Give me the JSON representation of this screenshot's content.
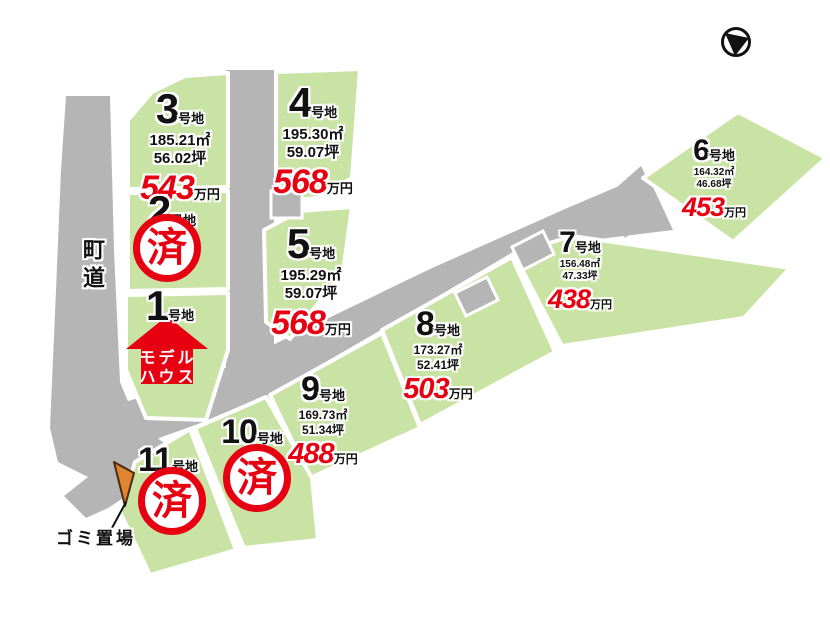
{
  "title": "宅地分譲区画図",
  "colors": {
    "lot_green": "#c9e3a5",
    "road_gray": "#b5b5b5",
    "price_red": "#e60012",
    "sold_red": "#e60012",
    "trash_orange": "#e0852f"
  },
  "labels": {
    "town_road": "町道",
    "trash_site": "ゴミ置場",
    "model_house_line1": "モデル",
    "model_house_line2": "ハウス",
    "sold": "済"
  },
  "lots": [
    {
      "number": "1",
      "suffix": "号地",
      "status": "model_house"
    },
    {
      "number": "2",
      "suffix": "号地",
      "status": "sold"
    },
    {
      "number": "3",
      "suffix": "号地",
      "area_m2": "185.21㎡",
      "area_tsubo": "56.02坪",
      "price": "543",
      "price_unit": "万円",
      "status": "for_sale"
    },
    {
      "number": "4",
      "suffix": "号地",
      "area_m2": "195.30㎡",
      "area_tsubo": "59.07坪",
      "price": "568",
      "price_unit": "万円",
      "status": "for_sale"
    },
    {
      "number": "5",
      "suffix": "号地",
      "area_m2": "195.29㎡",
      "area_tsubo": "59.07坪",
      "price": "568",
      "price_unit": "万円",
      "status": "for_sale"
    },
    {
      "number": "6",
      "suffix": "号地",
      "area_m2": "164.32㎡",
      "area_tsubo": "46.68坪",
      "price": "453",
      "price_unit": "万円",
      "status": "for_sale"
    },
    {
      "number": "7",
      "suffix": "号地",
      "area_m2": "156.48㎡",
      "area_tsubo": "47.33坪",
      "price": "438",
      "price_unit": "万円",
      "status": "for_sale"
    },
    {
      "number": "8",
      "suffix": "号地",
      "area_m2": "173.27㎡",
      "area_tsubo": "52.41坪",
      "price": "503",
      "price_unit": "万円",
      "status": "for_sale"
    },
    {
      "number": "9",
      "suffix": "号地",
      "area_m2": "169.73㎡",
      "area_tsubo": "51.34坪",
      "price": "488",
      "price_unit": "万円",
      "status": "for_sale"
    },
    {
      "number": "10",
      "suffix": "号地",
      "status": "sold"
    },
    {
      "number": "11",
      "suffix": "号地",
      "status": "sold"
    }
  ],
  "compass": {
    "icon": "north-arrow"
  }
}
